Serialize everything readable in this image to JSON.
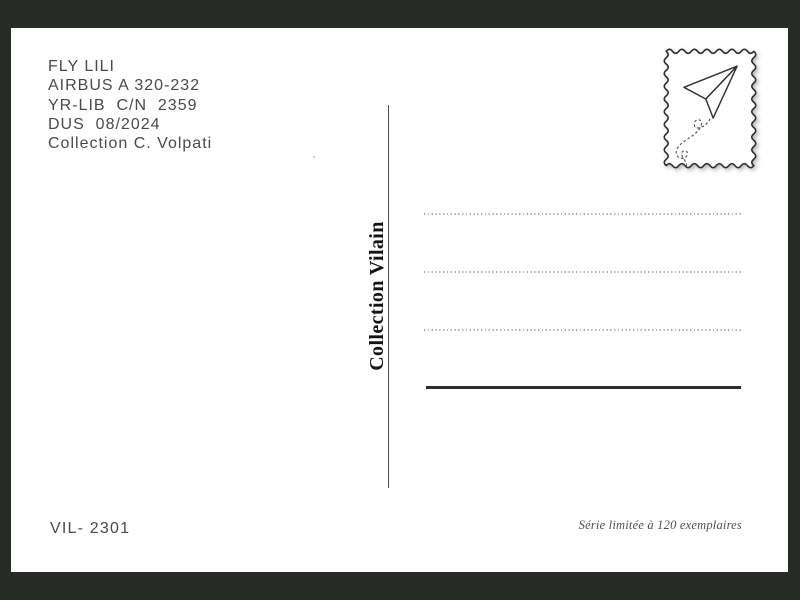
{
  "postcard": {
    "info_block": {
      "lines": [
        "FLY LILI",
        "AIRBUS A 320-232",
        "YR-LIB  C/N  2359",
        "DUS  08/2024",
        "Collection C. Volpati"
      ]
    },
    "publisher_label": "Collection Vilain",
    "catalog_number": "VIL- 2301",
    "edition_note": "Série limitée à 120 exemplaires",
    "stamp": {
      "icon": "paper-plane-stamp-icon"
    },
    "address_field": {
      "dotted_line_count": 3,
      "has_solid_line": true
    }
  },
  "colors": {
    "frame": "#272b26",
    "card": "#ffffff",
    "text_primary": "#4a4a4a",
    "publisher_text": "#141414",
    "dotted_line": "#b3b3b3",
    "solid_line": "#2d2d2d"
  }
}
